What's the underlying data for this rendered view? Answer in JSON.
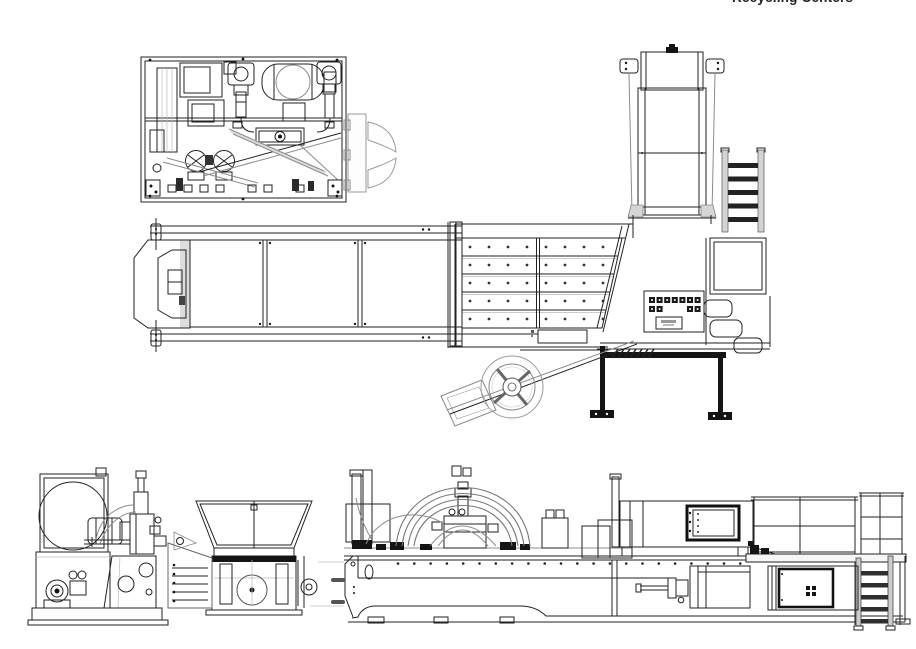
{
  "header": {
    "title": "Recycling Centers"
  },
  "palette": {
    "background": "#ffffff",
    "ink": "#222222",
    "ink_medium": "#555555",
    "ink_light": "#8c8c8c",
    "fill_dark": "#141414",
    "fill_gray": "#d6d6d6"
  },
  "components": {
    "slat_deck": {
      "rows": 5,
      "bolts_per_row": 8
    },
    "infeed_conveyor": {
      "cross_members": 2
    },
    "plan_access_ladder": {
      "rungs": 5
    },
    "side_access_ladder": {
      "rungs": 5
    },
    "control_panel": {
      "buttons_top_row": 7,
      "buttons_second_row_left": 2,
      "buttons_second_row_right": 2
    },
    "side_bolt_row": {
      "bolts": 22
    },
    "hydraulic_hoses": {
      "arcs": 4
    },
    "hatched_brace": {
      "hatch_lines": 7
    }
  }
}
